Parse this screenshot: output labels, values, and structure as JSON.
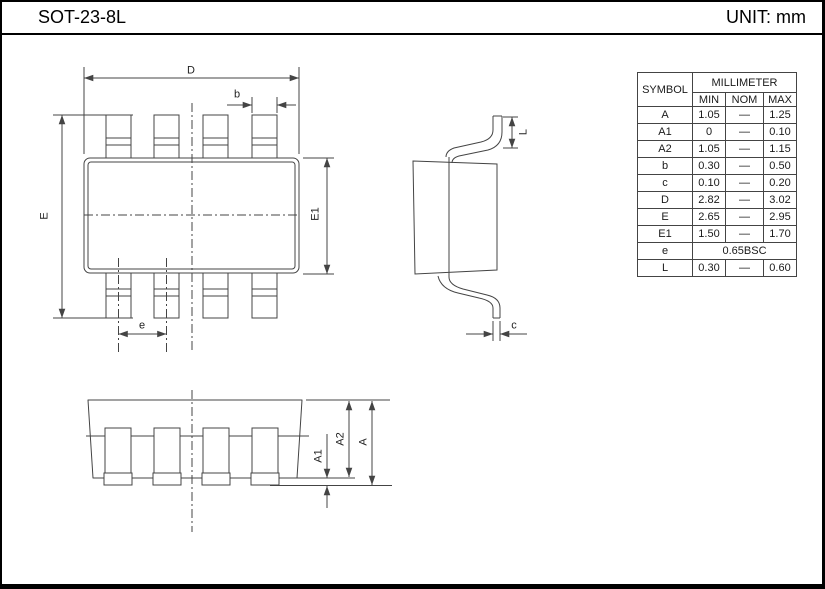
{
  "header": {
    "title": "SOT-23-8L",
    "unit": "UNIT: mm"
  },
  "drawing": {
    "dim_labels": {
      "D": "D",
      "b": "b",
      "E": "E",
      "E1": "E1",
      "e": "e",
      "L": "L",
      "c": "c",
      "A": "A",
      "A1": "A1",
      "A2": "A2"
    }
  },
  "table": {
    "col_symbol": "SYMBOL",
    "col_group": "MILLIMETER",
    "col_min": "MIN",
    "col_nom": "NOM",
    "col_max": "MAX",
    "rows": [
      {
        "symbol": "A",
        "min": "1.05",
        "nom": "—",
        "max": "1.25"
      },
      {
        "symbol": "A1",
        "min": "0",
        "nom": "—",
        "max": "0.10"
      },
      {
        "symbol": "A2",
        "min": "1.05",
        "nom": "—",
        "max": "1.15"
      },
      {
        "symbol": "b",
        "min": "0.30",
        "nom": "—",
        "max": "0.50"
      },
      {
        "symbol": "c",
        "min": "0.10",
        "nom": "—",
        "max": "0.20"
      },
      {
        "symbol": "D",
        "min": "2.82",
        "nom": "—",
        "max": "3.02"
      },
      {
        "symbol": "E",
        "min": "2.65",
        "nom": "—",
        "max": "2.95"
      },
      {
        "symbol": "E1",
        "min": "1.50",
        "nom": "—",
        "max": "1.70"
      },
      {
        "symbol": "e",
        "span": "0.65BSC"
      },
      {
        "symbol": "L",
        "min": "0.30",
        "nom": "—",
        "max": "0.60"
      }
    ]
  }
}
